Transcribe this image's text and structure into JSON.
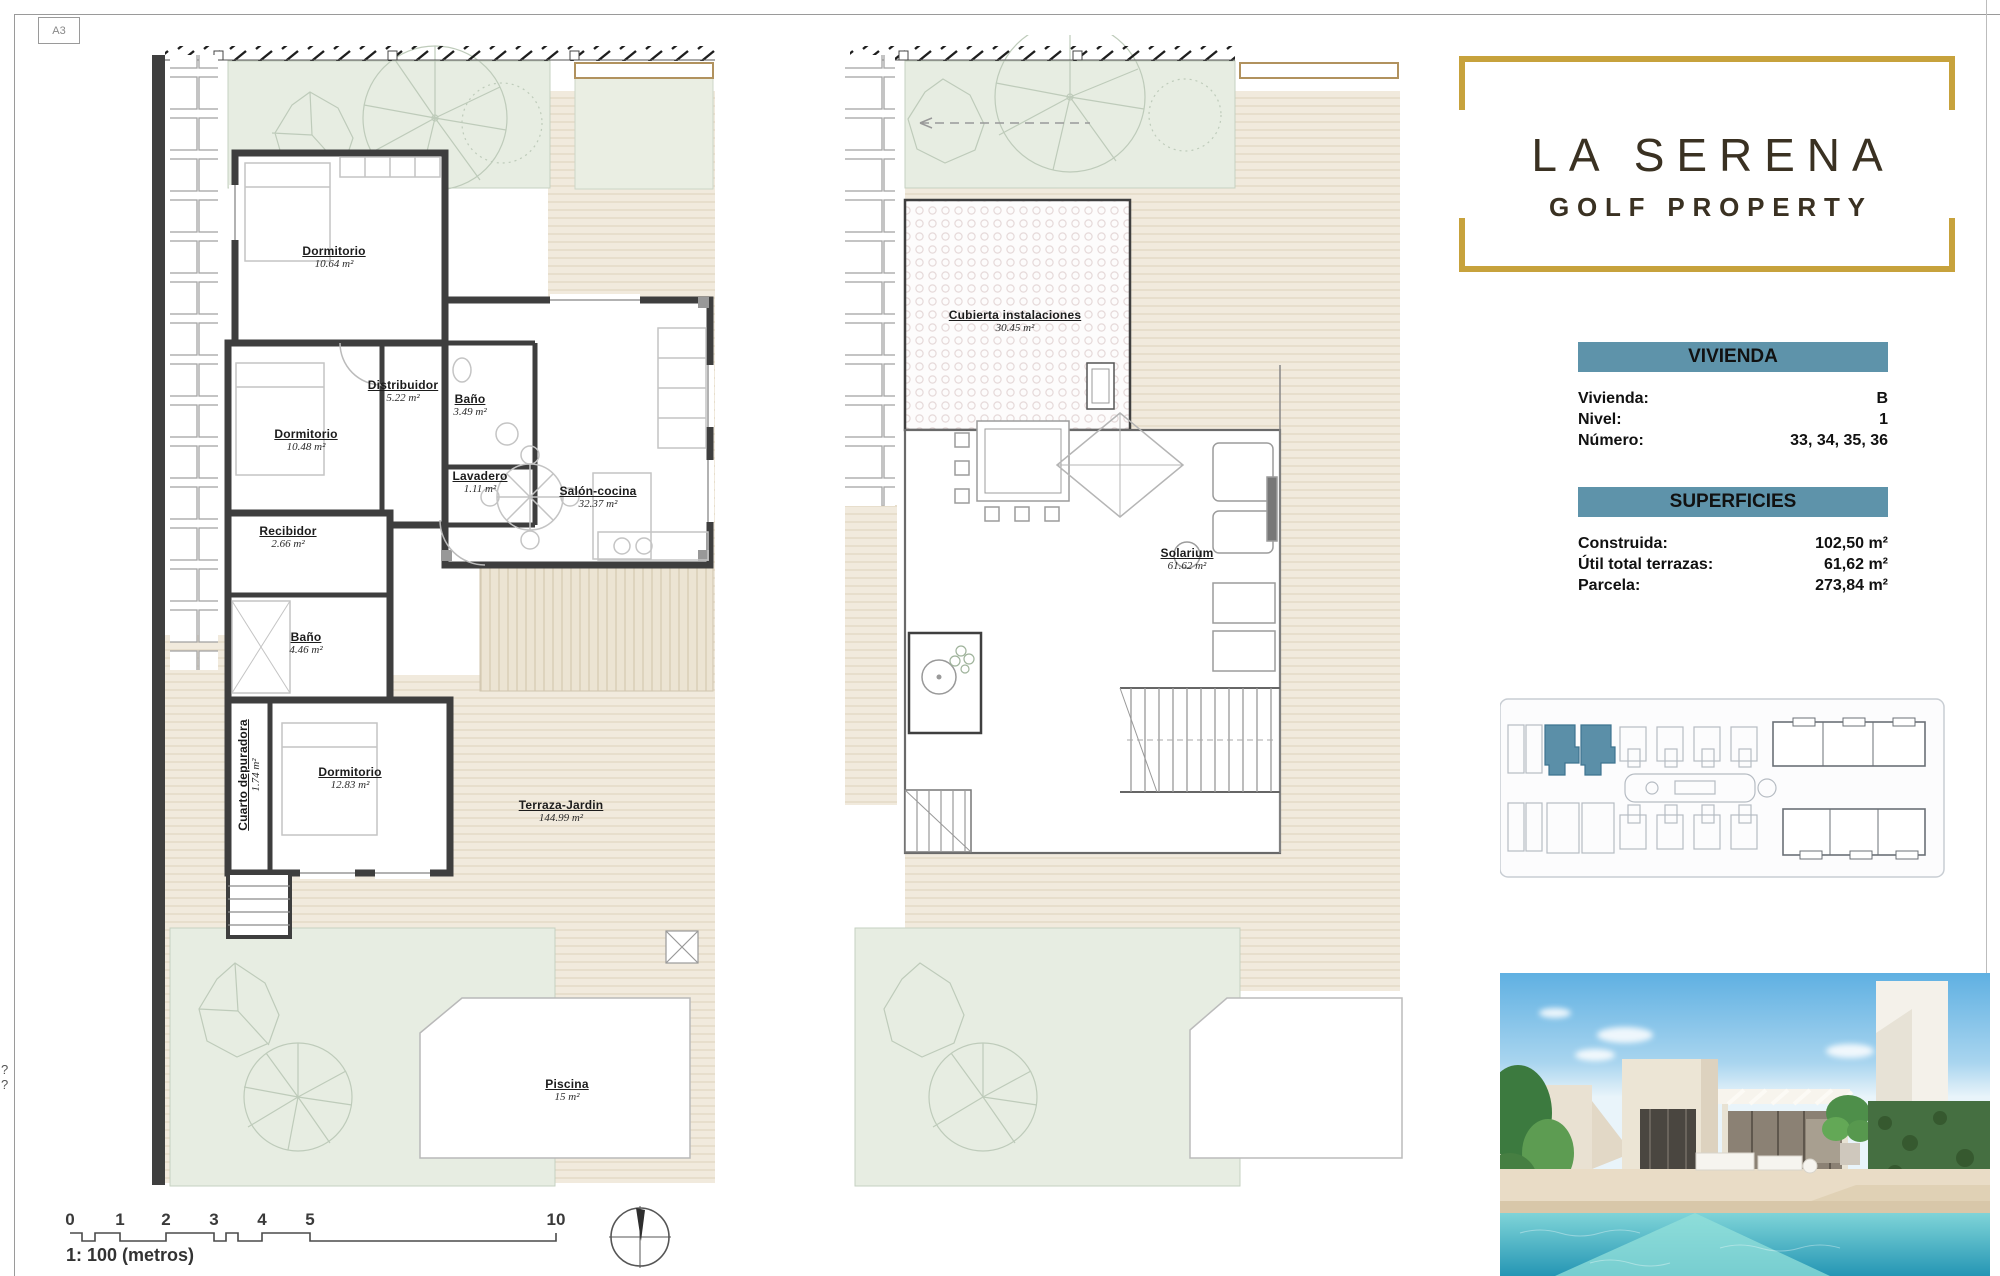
{
  "sheet": {
    "format_label": "A3",
    "edge_marks": "? ?"
  },
  "colors": {
    "accent_blue": "#5E93AA",
    "gold": "#C7A23C",
    "wall": "#3E3E3E"
  },
  "logo": {
    "line1": "LA SERENA",
    "line2": "GOLF PROPERTY"
  },
  "panels": {
    "vivienda": {
      "title": "VIVIENDA",
      "rows": [
        {
          "label": "Vivienda:",
          "value": "B"
        },
        {
          "label": "Nivel:",
          "value": "1"
        },
        {
          "label": "Número:",
          "value": "33, 34, 35, 36"
        }
      ]
    },
    "superficies": {
      "title": "SUPERFICIES",
      "rows": [
        {
          "label": "Construida:",
          "value": "102,50 m²"
        },
        {
          "label": "Útil total terrazas:",
          "value": "61,62 m²"
        },
        {
          "label": "Parcela:",
          "value": "273,84 m²"
        }
      ]
    }
  },
  "plans": {
    "ground": {
      "rooms": [
        {
          "label": "Dormitorio",
          "area": "10.64 m²",
          "x": 184,
          "y": 222
        },
        {
          "label": "Distribuidor",
          "area": "5.22 m²",
          "x": 253,
          "y": 356
        },
        {
          "label": "Baño",
          "area": "3.49 m²",
          "x": 320,
          "y": 370
        },
        {
          "label": "Dormitorio",
          "area": "10.48 m²",
          "x": 156,
          "y": 405
        },
        {
          "label": "Lavadero",
          "area": "1.11 m²",
          "x": 330,
          "y": 447
        },
        {
          "label": "Salón-cocina",
          "area": "32.37 m²",
          "x": 448,
          "y": 462
        },
        {
          "label": "Recibidor",
          "area": "2.66 m²",
          "x": 138,
          "y": 502
        },
        {
          "label": "Baño",
          "area": "4.46 m²",
          "x": 156,
          "y": 608
        },
        {
          "label": "Cuarto depuradora",
          "area": "1.74 m²",
          "x": 99,
          "y": 740,
          "vertical": true
        },
        {
          "label": "Dormitorio",
          "area": "12.83 m²",
          "x": 200,
          "y": 743
        },
        {
          "label": "Terraza-Jardin",
          "area": "144.99 m²",
          "x": 411,
          "y": 776
        },
        {
          "label": "Piscina",
          "area": "15 m²",
          "x": 417,
          "y": 1055
        }
      ]
    },
    "roof": {
      "rooms": [
        {
          "label": "Cubierta instalaciones",
          "area": "30.45 m²",
          "x": 180,
          "y": 286
        },
        {
          "label": "Solarium",
          "area": "61.62 m²",
          "x": 352,
          "y": 524
        }
      ]
    }
  },
  "scalebar": {
    "ticks": [
      {
        "label": "0",
        "x": 30
      },
      {
        "label": "1",
        "x": 80
      },
      {
        "label": "2",
        "x": 126
      },
      {
        "label": "3",
        "x": 174
      },
      {
        "label": "4",
        "x": 222
      },
      {
        "label": "5",
        "x": 270
      },
      {
        "label": "10",
        "x": 516
      }
    ],
    "label": "1: 100 (metros)"
  }
}
